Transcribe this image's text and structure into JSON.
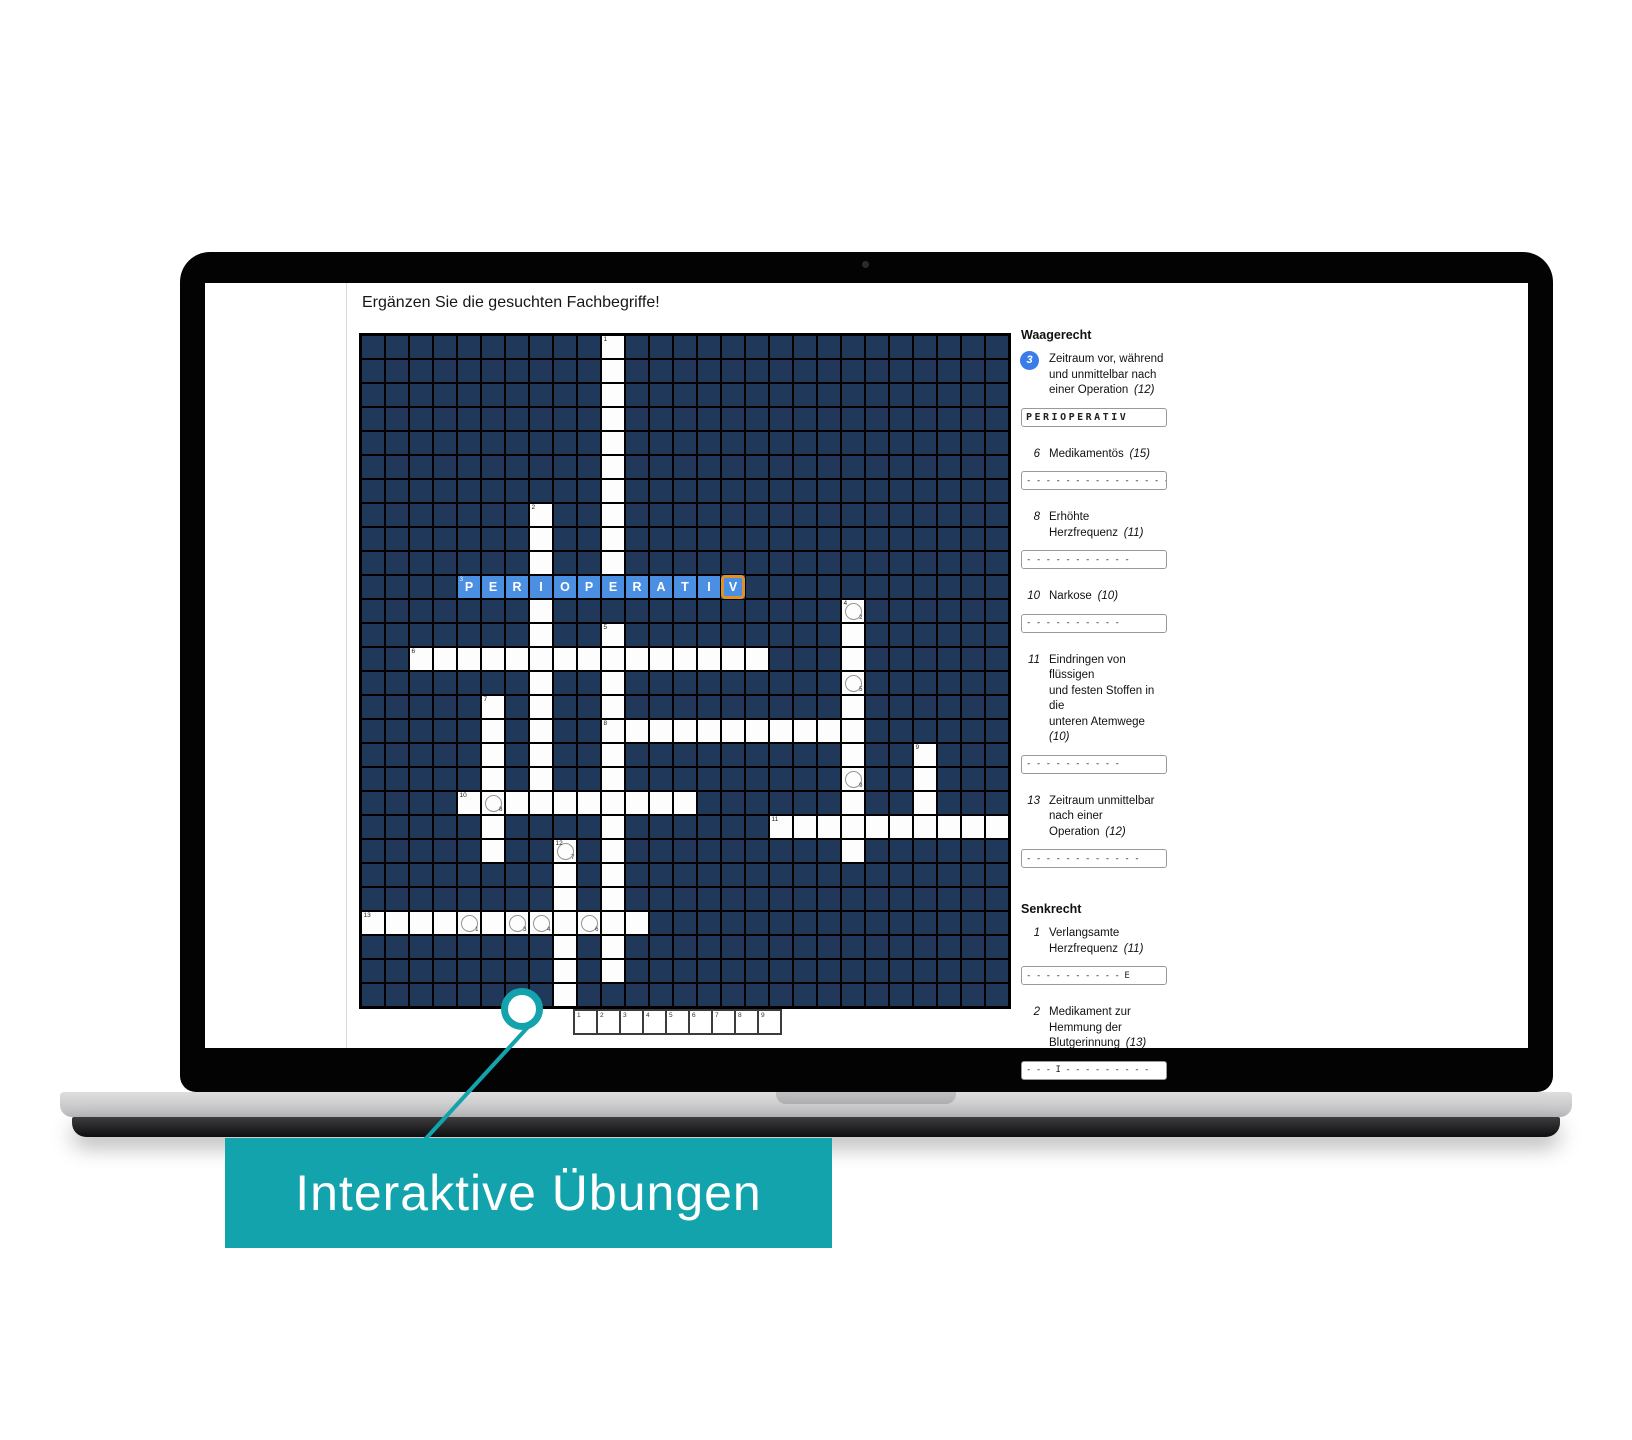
{
  "app": {
    "title": "Ergänzen Sie die gesuchten Fachbegriffe!",
    "grid": {
      "cols": 27,
      "rows": 28,
      "cell_px": 24,
      "colors": {
        "dark_cell": "#20395b",
        "line": "#000000",
        "white_cell": "#fdfdfd",
        "letter_cell": "#4a8fe2",
        "letter_text": "#ffffff",
        "selected_border": "#e0912f"
      },
      "words": [
        {
          "label": "1",
          "dir": "down",
          "col": 10,
          "row": 0,
          "len": 11
        },
        {
          "label": "2",
          "dir": "down",
          "col": 7,
          "row": 7,
          "len": 13
        },
        {
          "label": "3",
          "dir": "across",
          "col": 4,
          "row": 10,
          "len": 12,
          "letters": "PERIOPERATIV",
          "selected_index": 11
        },
        {
          "label": "4",
          "dir": "down",
          "col": 20,
          "row": 11,
          "len": 11
        },
        {
          "label": "5",
          "dir": "down",
          "col": 10,
          "row": 12,
          "len": 15
        },
        {
          "label": "6",
          "dir": "across",
          "col": 2,
          "row": 13,
          "len": 15
        },
        {
          "label": "7",
          "dir": "down",
          "col": 5,
          "row": 15,
          "len": 7
        },
        {
          "label": "8",
          "dir": "across",
          "col": 10,
          "row": 16,
          "len": 11
        },
        {
          "label": "9",
          "dir": "down",
          "col": 23,
          "row": 17,
          "len": 4
        },
        {
          "label": "10",
          "dir": "across",
          "col": 4,
          "row": 19,
          "len": 10
        },
        {
          "label": "11",
          "dir": "across",
          "col": 17,
          "row": 20,
          "len": 10
        },
        {
          "label": "12",
          "dir": "down",
          "col": 8,
          "row": 21,
          "len": 7
        },
        {
          "label": "13",
          "dir": "across",
          "col": 0,
          "row": 24,
          "len": 12
        }
      ],
      "circles": [
        {
          "col": 4,
          "row": 24,
          "digit": "1"
        },
        {
          "col": 20,
          "row": 11,
          "digit": "2"
        },
        {
          "col": 6,
          "row": 24,
          "digit": "3"
        },
        {
          "col": 7,
          "row": 24,
          "digit": "4"
        },
        {
          "col": 20,
          "row": 14,
          "digit": "5"
        },
        {
          "col": 9,
          "row": 24,
          "digit": "6"
        },
        {
          "col": 8,
          "row": 21,
          "digit": "7"
        },
        {
          "col": 5,
          "row": 19,
          "digit": "8"
        },
        {
          "col": 20,
          "row": 18,
          "digit": "9"
        }
      ]
    },
    "solution_strip": {
      "numbers": [
        "1",
        "2",
        "3",
        "4",
        "5",
        "6",
        "7",
        "8",
        "9"
      ]
    },
    "clues": {
      "waagerecht": {
        "header": "Waagerecht",
        "items": [
          {
            "num": "3",
            "badge": true,
            "lines": [
              "Zeitraum vor, während",
              "und unmittelbar nach",
              "einer Operation"
            ],
            "length_note": "(12)",
            "input_value": "PERIOPERATIV",
            "input_style": "letters"
          },
          {
            "num": "6",
            "lines": [
              "Medikamentös"
            ],
            "length_note": "(15)",
            "input_value": "- - - - - - - - - - - - - - -",
            "input_style": "dashes"
          },
          {
            "num": "8",
            "lines": [
              "Erhöhte",
              "Herzfrequenz"
            ],
            "length_note": "(11)",
            "input_value": "- - - - - - - - - - -",
            "input_style": "dashes"
          },
          {
            "num": "10",
            "lines": [
              "Narkose"
            ],
            "length_note": "(10)",
            "input_value": "- - - - - - - - - -",
            "input_style": "dashes"
          },
          {
            "num": "11",
            "lines": [
              "Eindringen von flüssigen",
              "und festen Stoffen in die",
              "unteren Atemwege"
            ],
            "length_note": "(10)",
            "input_value": "- - - - - - - - - -",
            "input_style": "dashes"
          },
          {
            "num": "13",
            "lines": [
              "Zeitraum unmittelbar",
              "nach einer",
              "Operation"
            ],
            "length_note": "(12)",
            "input_value": "- - - - - - - - - - - -",
            "input_style": "dashes"
          }
        ]
      },
      "senkrecht": {
        "header": "Senkrecht",
        "items": [
          {
            "num": "1",
            "lines": [
              "Verlangsamte",
              "Herzfrequenz"
            ],
            "length_note": "(11)",
            "input_value": "- - - - - - - - - - E",
            "input_style": "dashes"
          },
          {
            "num": "2",
            "lines": [
              "Medikament zur",
              "Hemmung der",
              "Blutgerinnung"
            ],
            "length_note": "(13)",
            "input_value": "- - - I - - - - - - - - -",
            "input_style": "dashes"
          }
        ]
      }
    }
  },
  "callout": {
    "banner_label": "Interaktive Übungen",
    "accent_color": "#13a3ad"
  }
}
